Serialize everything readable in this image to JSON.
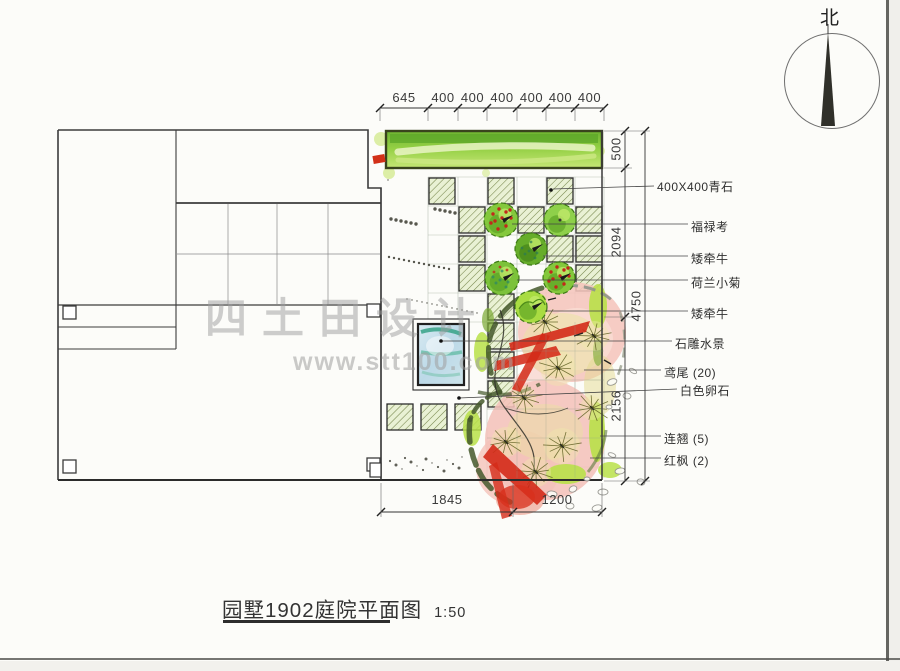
{
  "compass": {
    "label": "北"
  },
  "watermark": {
    "line1": "四土田设计",
    "line2": "www.stt100.com"
  },
  "title_block": {
    "title": "园墅1902庭院平面图",
    "scale": "1:50"
  },
  "dimensions": {
    "top": {
      "line_y": 108,
      "ticks_x": [
        380,
        428,
        458,
        487,
        517,
        546,
        575,
        604
      ],
      "labels": [
        "645",
        "400",
        "400",
        "400",
        "400",
        "400",
        "400"
      ]
    },
    "right_inner": {
      "x": 625,
      "ticks_y": [
        131,
        168,
        317,
        481
      ],
      "labels": [
        {
          "text": "500",
          "cy": 149
        },
        {
          "text": "2094",
          "cy": 242
        },
        {
          "text": "2156",
          "cy": 406
        }
      ]
    },
    "right_outer": {
      "x": 645,
      "ticks_y": [
        131,
        481
      ],
      "labels": [
        {
          "text": "4750",
          "cy": 306
        }
      ]
    },
    "bottom": {
      "line_y": 512,
      "ticks_x": [
        381,
        513,
        602
      ],
      "labels": [
        {
          "text": "1845",
          "cx": 447
        },
        {
          "text": "1200",
          "cx": 557
        }
      ]
    }
  },
  "annotations": [
    {
      "text": "400X400青石",
      "x": 657,
      "y": 178,
      "leader": [
        553,
        189,
        654,
        186
      ],
      "dot": [
        551,
        190
      ]
    },
    {
      "text": "福禄考",
      "x": 691,
      "y": 218,
      "leader": [
        512,
        224,
        688,
        224
      ]
    },
    {
      "text": "矮牵牛",
      "x": 691,
      "y": 250,
      "leader": [
        543,
        256,
        688,
        256
      ]
    },
    {
      "text": "荷兰小菊",
      "x": 691,
      "y": 274,
      "leader": [
        517,
        280,
        688,
        280
      ]
    },
    {
      "text": "矮牵牛",
      "x": 691,
      "y": 305,
      "leader": [
        545,
        311,
        688,
        311
      ]
    },
    {
      "text": "石雕水景",
      "x": 675,
      "y": 335,
      "leader": [
        441,
        341,
        672,
        341
      ],
      "dot": [
        441,
        341
      ]
    },
    {
      "text": "鸢尾 (20)",
      "x": 664,
      "y": 364,
      "leader": [
        584,
        370,
        661,
        370
      ]
    },
    {
      "text": "白色卵石",
      "x": 680,
      "y": 382,
      "leader": [
        459,
        398,
        677,
        389
      ],
      "dot": [
        459,
        398
      ]
    },
    {
      "text": "连翘 (5)",
      "x": 664,
      "y": 430,
      "leader": [
        600,
        436,
        661,
        436
      ]
    },
    {
      "text": "红枫 (2)",
      "x": 664,
      "y": 452,
      "leader": [
        590,
        458,
        661,
        458
      ]
    }
  ],
  "plan": {
    "cell_size": 27,
    "paving_cells": [
      [
        428,
        177
      ],
      [
        487,
        177
      ],
      [
        546,
        177
      ],
      [
        458,
        206
      ],
      [
        517,
        206
      ],
      [
        575,
        206
      ],
      [
        458,
        235
      ],
      [
        546,
        235
      ],
      [
        575,
        235
      ],
      [
        458,
        264
      ],
      [
        575,
        264
      ],
      [
        487,
        293
      ],
      [
        487,
        322
      ],
      [
        487,
        351
      ],
      [
        487,
        380
      ],
      [
        386,
        403
      ],
      [
        420,
        403
      ],
      [
        454,
        403
      ]
    ],
    "shrubs": [
      {
        "cx": 501,
        "cy": 220,
        "r": 17,
        "type": "red"
      },
      {
        "cx": 560,
        "cy": 220,
        "r": 16,
        "type": "plain"
      },
      {
        "cx": 531,
        "cy": 249,
        "r": 16,
        "type": "dark"
      },
      {
        "cx": 502,
        "cy": 278,
        "r": 17,
        "type": "teal"
      },
      {
        "cx": 559,
        "cy": 278,
        "r": 16,
        "type": "red"
      },
      {
        "cx": 531,
        "cy": 307,
        "r": 16,
        "type": "leafy"
      }
    ],
    "colors": {
      "paving_hatch": "#75854a",
      "shrub_green": "#84c83c",
      "berry_red": "#c2281a",
      "strip_green": "#93cf43",
      "pool_blue": "#bcd9e8",
      "canopy_pink": "#f5c5bc",
      "stroke_red": "#d42a18",
      "line_dark": "#3c3c3c"
    }
  }
}
